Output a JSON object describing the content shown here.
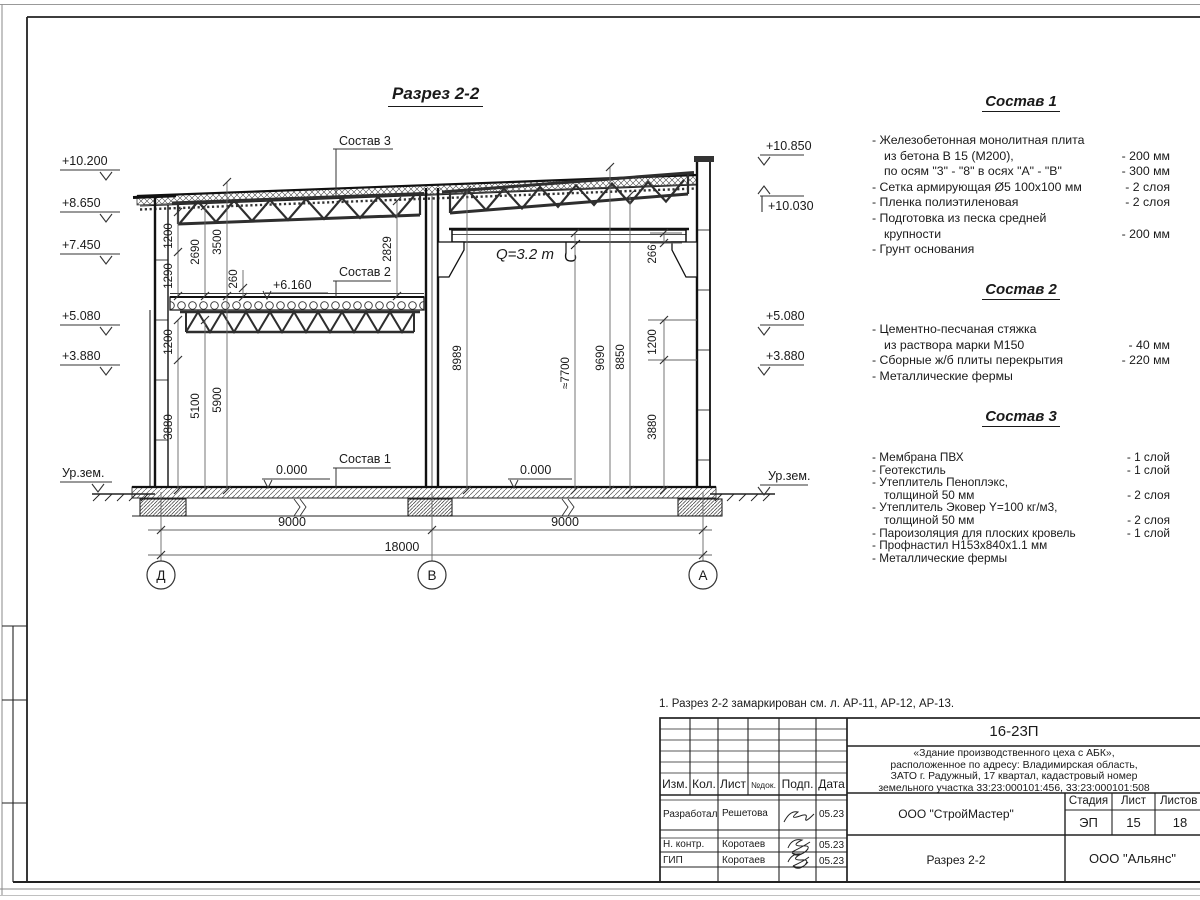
{
  "sheet": {
    "title": "Разрез 2-2",
    "note": "1. Разрез 2-2 замаркирован см. л. АР-11, АР-12, АР-13."
  },
  "section": {
    "elev_left": [
      "+10.200",
      "+8.650",
      "+7.450",
      "+5.080",
      "+3.880",
      "Ур.зем."
    ],
    "elev_right": [
      "+10.850",
      "+10.030",
      "+5.080",
      "+3.880",
      "Ур.зем."
    ],
    "dims": {
      "l_1200_top": "1200",
      "l_1290": "1290",
      "l_2690": "2690",
      "l_3500": "3500",
      "l_260": "260",
      "l_2829": "2829",
      "l_1200_mid": "1200",
      "l_3880": "3880",
      "l_5100": "5100",
      "l_5900": "5900",
      "r_8989": "8989",
      "r_7700": "≈7700",
      "r_9690": "9690",
      "r_8850": "8850",
      "r_266": "266",
      "r_1200": "1200",
      "r_3880": "3880"
    },
    "spans": {
      "left": "9000",
      "right": "9000",
      "total": "18000"
    },
    "axes": [
      "Д",
      "В",
      "А"
    ],
    "labels": {
      "sostav1": "Состав 1",
      "sostav2": "Состав 2",
      "sostav3": "Состав 3",
      "level_6160": "+6.160",
      "zero_left": "0.000",
      "zero_right": "0.000",
      "crane": "Q=3.2 т"
    }
  },
  "compositions": [
    {
      "title": "Состав 1",
      "rows": [
        {
          "t": "- Железобетонная  монолитная плита",
          "v": ""
        },
        {
          "t": "из бетона В 15 (М200),",
          "v": "- 200 мм",
          "i": 1
        },
        {
          "t": "по осям \"3\" - \"8\" в осях \"А\" - \"В\"",
          "v": "- 300 мм",
          "i": 1
        },
        {
          "t": "- Сетка армирующая Ø5 100х100 мм",
          "v": "- 2 слоя"
        },
        {
          "t": "- Пленка полиэтиленовая",
          "v": "- 2 слоя"
        },
        {
          "t": "- Подготовка из песка средней",
          "v": ""
        },
        {
          "t": "крупности",
          "v": "- 200 мм",
          "i": 1
        },
        {
          "t": "- Грунт основания",
          "v": ""
        }
      ]
    },
    {
      "title": "Состав 2",
      "rows": [
        {
          "t": "- Цементно-песчаная стяжка",
          "v": ""
        },
        {
          "t": "из раствора марки М150",
          "v": "- 40 мм",
          "i": 1
        },
        {
          "t": "- Сборные ж/б плиты перекрытия",
          "v": "- 220 мм"
        },
        {
          "t": "- Металлические фермы",
          "v": ""
        }
      ]
    },
    {
      "title": "Состав 3",
      "rows": [
        {
          "t": "- Мембрана ПВХ",
          "v": "- 1 слой"
        },
        {
          "t": "- Геотекстиль",
          "v": "- 1 слой"
        },
        {
          "t": "- Утеплитель Пеноплэкс,",
          "v": ""
        },
        {
          "t": "толщиной 50 мм",
          "v": "- 2 слоя",
          "i": 1
        },
        {
          "t": "- Утеплитель Эковер Y=100 кг/м3,",
          "v": ""
        },
        {
          "t": "толщиной 50 мм",
          "v": "- 2 слоя",
          "i": 1
        },
        {
          "t": "- Пароизоляция для плоских кровель",
          "v": "- 1 слой"
        },
        {
          "t": "- Профнастил Н153х840х1.1 мм",
          "v": ""
        },
        {
          "t": "- Металлические фермы",
          "v": ""
        }
      ]
    }
  ],
  "titleblock": {
    "doc_number": "16-23П",
    "description": [
      "«Здание производственного цеха с АБК»,",
      "расположенное по адресу: Владимирская область,",
      "ЗАТО г. Радужный, 17 квартал, кадастровый номер",
      "земельного участка 33:23:000101:456, 33:23:000101:508"
    ],
    "columns": {
      "izm": "Изм.",
      "kol": "Кол.",
      "list": "Лист",
      "ndok": "№док.",
      "podp": "Подп.",
      "data": "Дата"
    },
    "stage_label": "Стадия",
    "sheet_label": "Лист",
    "sheets_label": "Листов",
    "stage": "ЭП",
    "sheet_num": "15",
    "sheets_total": "18",
    "contractor": "ООО \"СтройМастер\"",
    "client": "ООО \"Альянс\"",
    "drawing_name": "Разрез 2-2",
    "roles": [
      {
        "role": "Разработал",
        "name": "Решетова",
        "date": "05.23"
      },
      {
        "role": "Н. контр.",
        "name": "Коротаев",
        "date": "05.23"
      },
      {
        "role": "ГИП",
        "name": "Коротаев",
        "date": "05.23"
      }
    ]
  }
}
